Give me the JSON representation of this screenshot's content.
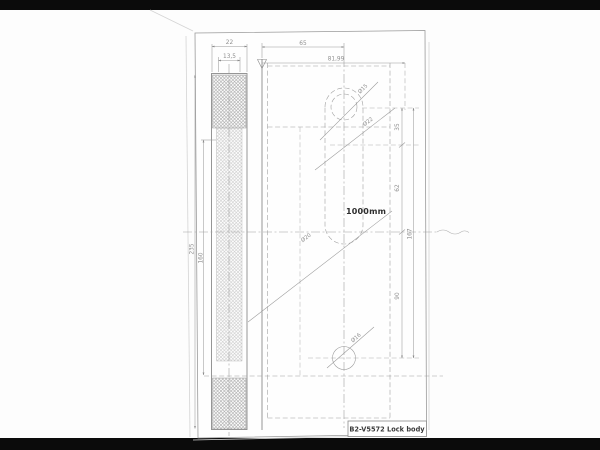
{
  "drawing": {
    "title_block": {
      "label": "B2-V5572 Lock body"
    },
    "note": {
      "length_note": "1000mm"
    },
    "faceplate_dims": {
      "width": "22",
      "inner_width": "13,5",
      "height": "235",
      "inner_height": "160"
    },
    "top_dims": {
      "backset": "65",
      "overall": "81,99"
    },
    "right_dims": {
      "seg_top": "35",
      "seg_mid": "62",
      "seg_bottom": "90",
      "overall": "167"
    },
    "hole_dims": {
      "cylinder_top": "Ø15",
      "cylinder_body": "Ø22",
      "cylinder_bottom": "Ø20",
      "spindle": "Ø16"
    },
    "colors": {
      "ink": "#8a8a8a",
      "paper": "#fdfdfd",
      "scan_bar": "#0b0b0b",
      "hatch_dark": "#a3a3a3",
      "hatch_light": "#c4c4c4"
    }
  }
}
